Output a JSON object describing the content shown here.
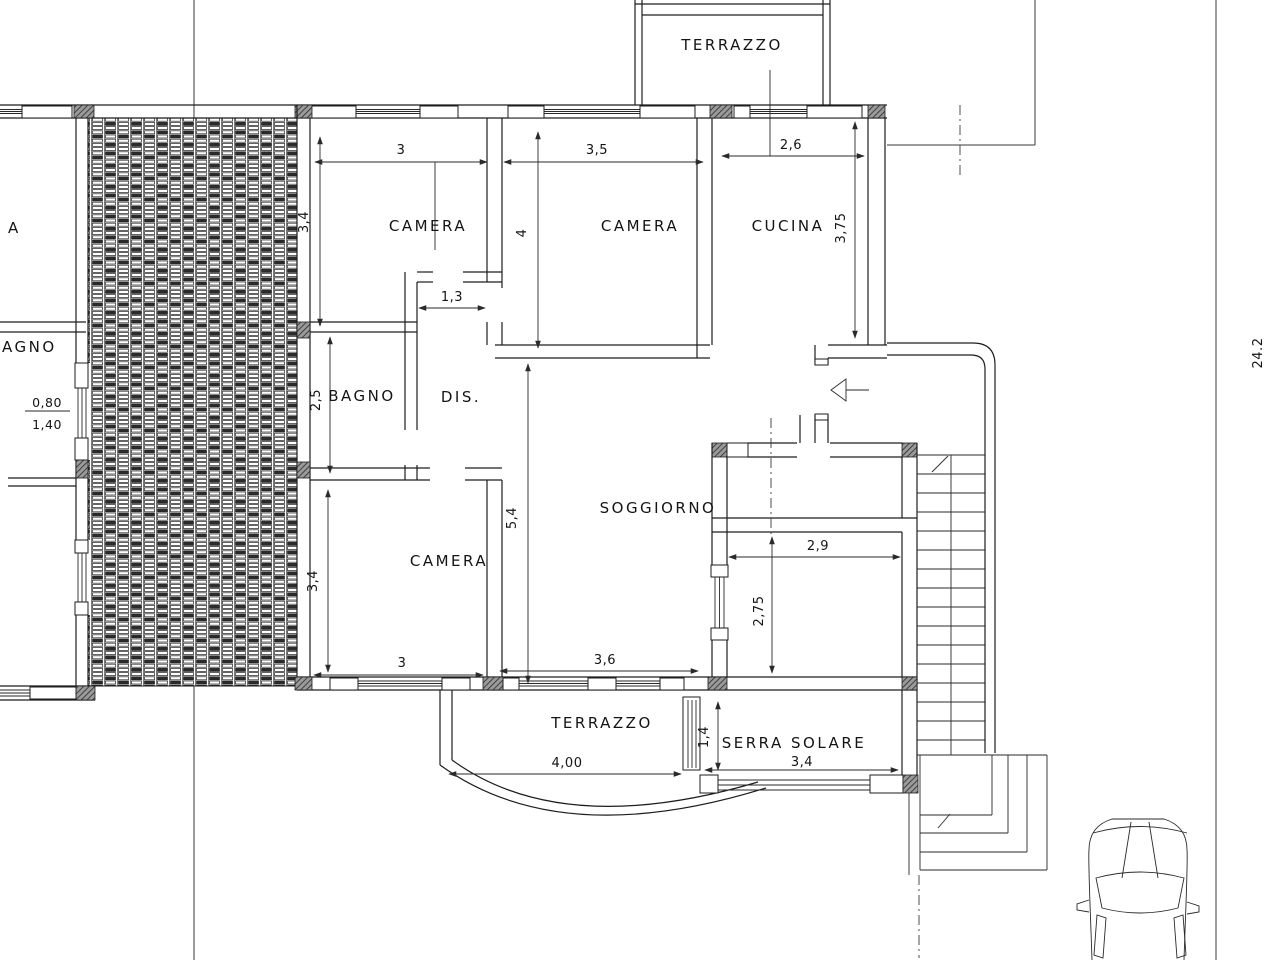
{
  "plan_type": "apartment-floor-plan",
  "labels": {
    "terrace_top": "TERRAZZO",
    "camera1": "CAMERA",
    "camera2": "CAMERA",
    "cucina": "CUCINA",
    "bagno": "BAGNO",
    "dis": "DIS.",
    "soggiorno": "SOGGIORNO",
    "camera3": "CAMERA",
    "terrace_bottom": "TERRAZZO",
    "serra_solare": "SERRA SOLARE",
    "neighbor_partial_a": "A",
    "neighbor_partial_bagno": "AGNO"
  },
  "dims": {
    "camera1_w": "3",
    "camera1_h": "3,4",
    "camera2_w": "3,5",
    "camera2_h": "4",
    "cucina_w": "2,6",
    "cucina_h": "3,75",
    "dis_w": "1,3",
    "bagno_h": "2,5",
    "soggiorno_h": "5,4",
    "camera3_h": "3,4",
    "camera3_w": "3",
    "soggiorno_w": "3,6",
    "nook_w": "2,9",
    "nook_h": "2,75",
    "serra_depth": "1,4",
    "serra_w": "3,4",
    "terrace_w": "4,00",
    "window_sill": "0,80",
    "window_height": "1,40",
    "site_length": "24.2"
  }
}
